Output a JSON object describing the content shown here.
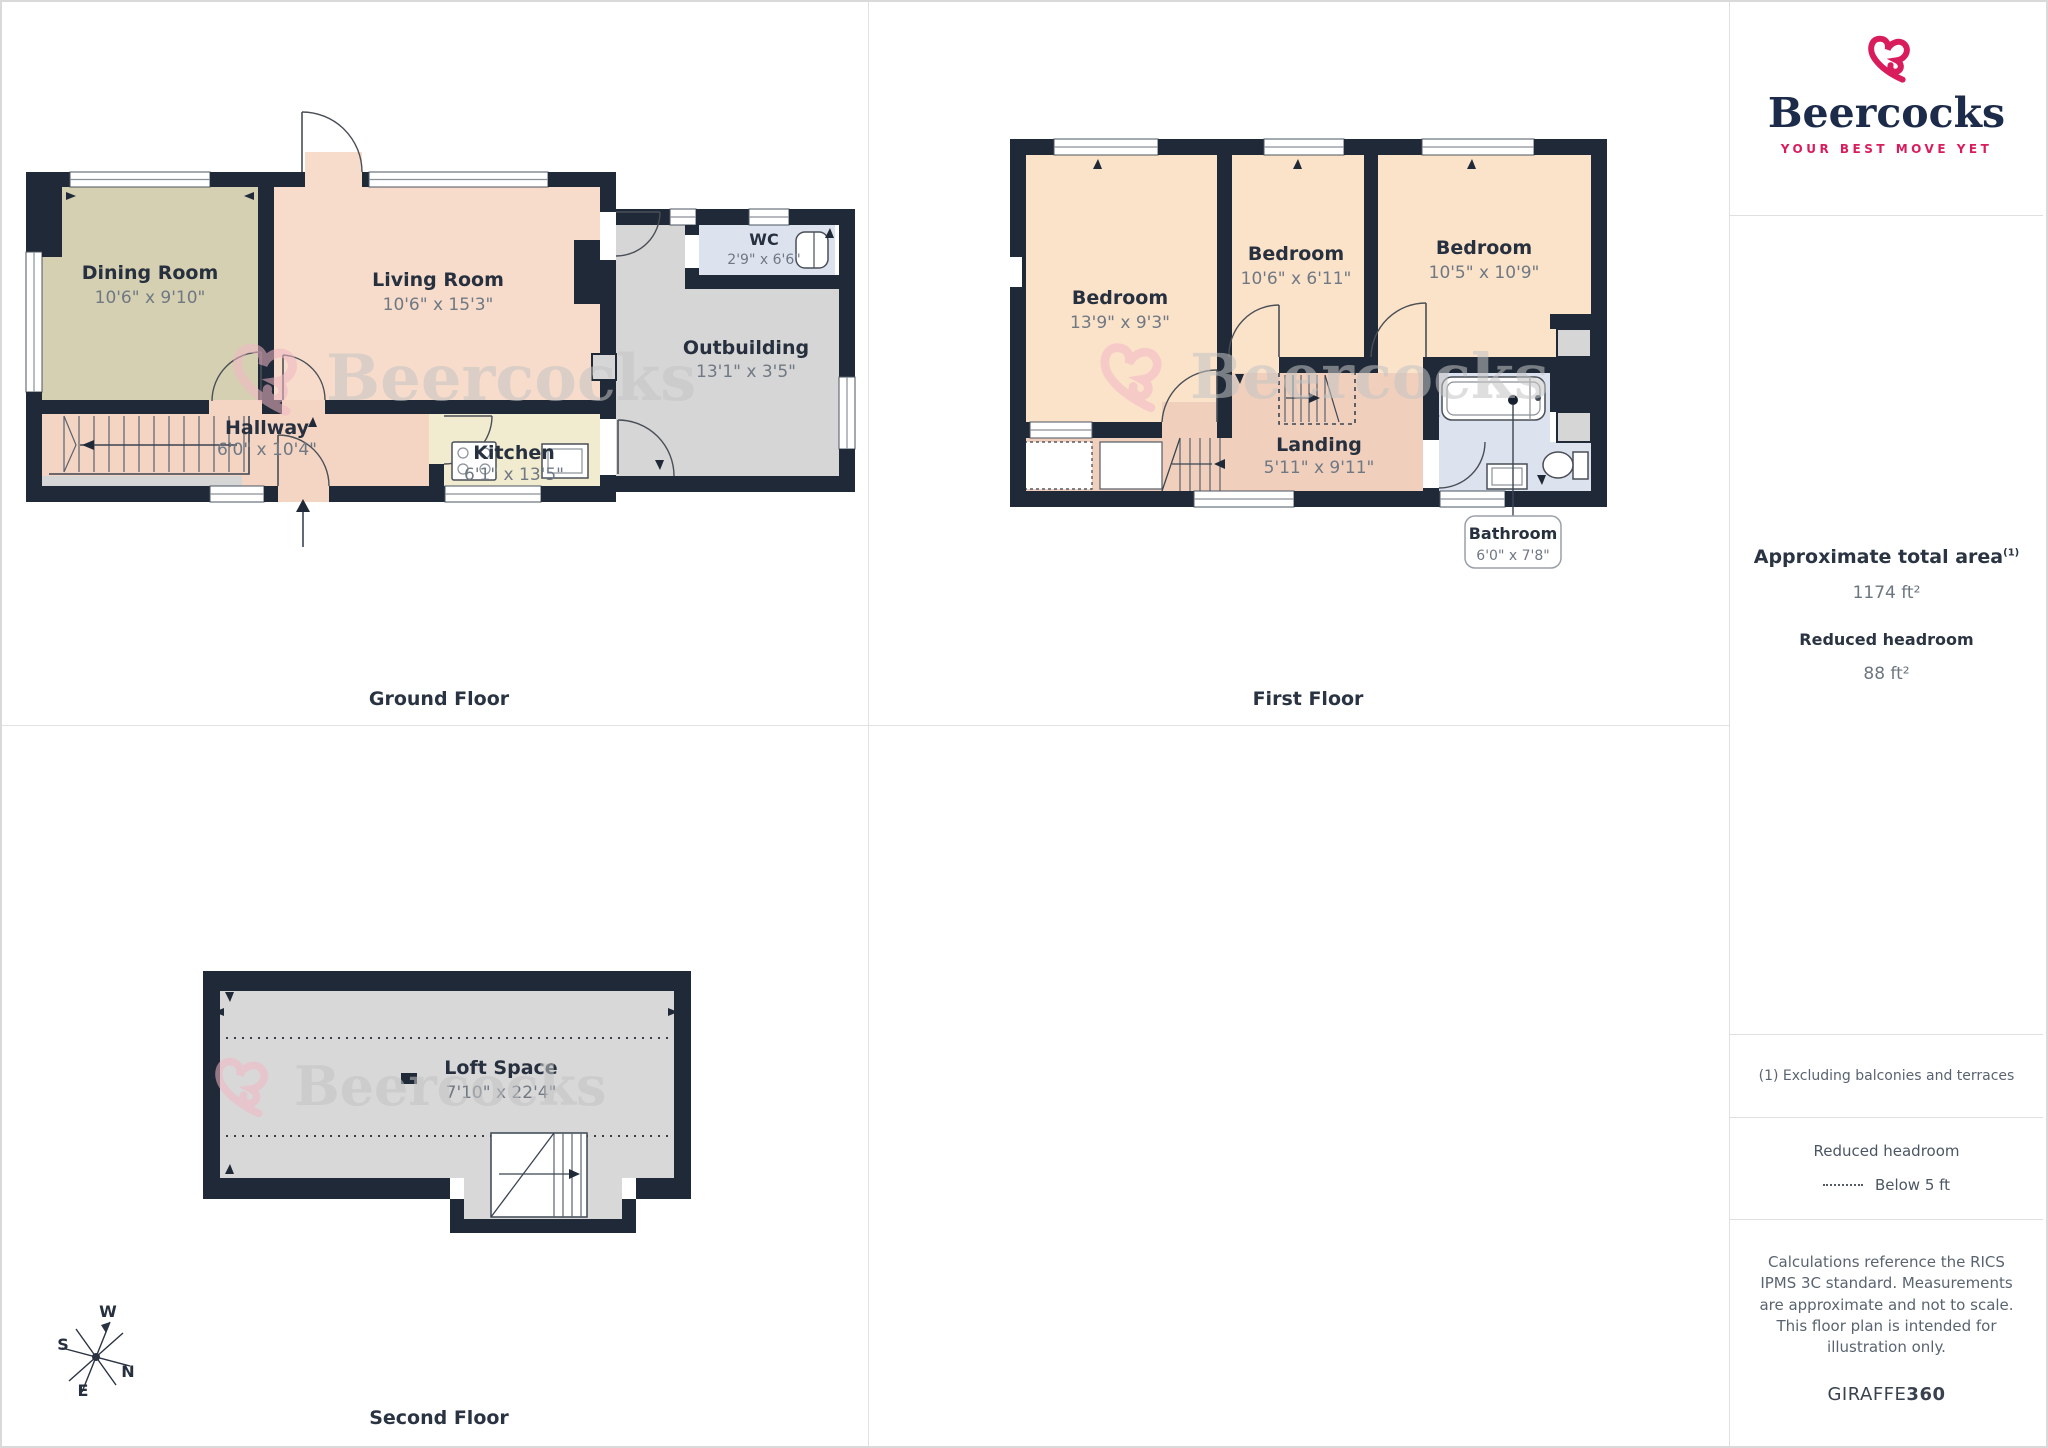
{
  "branding": {
    "name": "Beercocks",
    "tagline": "YOUR BEST MOVE YET",
    "brand_pink": "#d91d5c",
    "brand_navy": "#1c2b4a"
  },
  "watermark": {
    "text": "Beercocks"
  },
  "floors": {
    "ground": {
      "label": "Ground Floor",
      "rooms": {
        "dining": {
          "name": "Dining Room",
          "dims": "10'6\" x 9'10\""
        },
        "living": {
          "name": "Living Room",
          "dims": "10'6\" x 15'3\""
        },
        "hallway": {
          "name": "Hallway",
          "dims": "6'0\" x 10'4\""
        },
        "kitchen": {
          "name": "Kitchen",
          "dims": "6'1\" x 13'5\""
        },
        "wc": {
          "name": "WC",
          "dims": "2'9\" x 6'6\""
        },
        "outbuilding": {
          "name": "Outbuilding",
          "dims": "13'1\" x 3'5\""
        }
      }
    },
    "first": {
      "label": "First Floor",
      "rooms": {
        "bedroom1": {
          "name": "Bedroom",
          "dims": "13'9\" x 9'3\""
        },
        "bedroom2": {
          "name": "Bedroom",
          "dims": "10'6\" x 6'11\""
        },
        "bedroom3": {
          "name": "Bedroom",
          "dims": "10'5\" x 10'9\""
        },
        "landing": {
          "name": "Landing",
          "dims": "5'11\" x 9'11\""
        },
        "bathroom": {
          "name": "Bathroom",
          "dims": "6'0\" x 7'8\""
        }
      }
    },
    "second": {
      "label": "Second Floor",
      "rooms": {
        "loft": {
          "name": "Loft Space",
          "dims": "7'10\" x 22'4\""
        }
      }
    }
  },
  "sidebar": {
    "area_title": "Approximate total area",
    "area_sup": "(1)",
    "area_value": "1174 ft²",
    "headroom_title": "Reduced headroom",
    "headroom_value": "88 ft²",
    "note": "(1) Excluding balconies and terraces",
    "legend_title": "Reduced headroom",
    "legend_item": "Below 5 ft",
    "disclaimer": "Calculations reference the RICS IPMS 3C standard. Measurements are approximate and not to scale. This floor plan is intended for illustration only.",
    "brand_footer_1": "GIRAFFE",
    "brand_footer_2": "360"
  },
  "compass": {
    "n": "N",
    "s": "S",
    "e": "E",
    "w": "W"
  }
}
